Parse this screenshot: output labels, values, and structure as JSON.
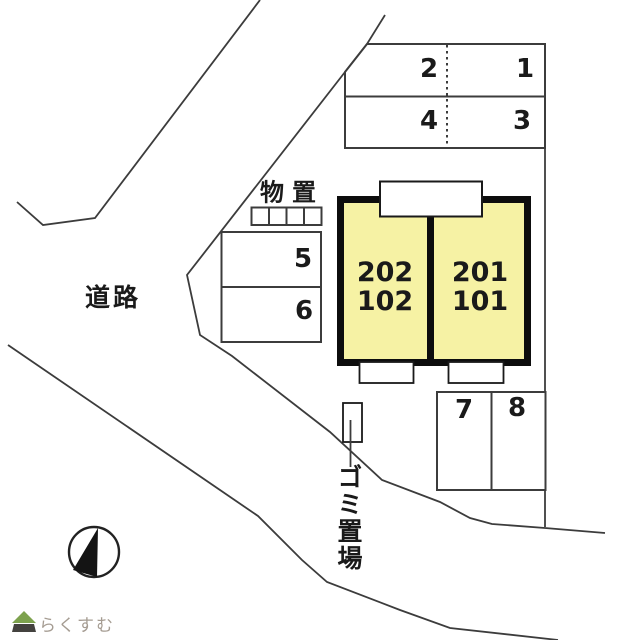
{
  "plan": {
    "road_label": "道路",
    "storage_label": "物置",
    "garbage_label": "ゴミ置場",
    "building": {
      "unit_left_upper": "202",
      "unit_left_lower": "102",
      "unit_right_upper": "201",
      "unit_right_lower": "101"
    },
    "parking": {
      "north_block": [
        "2",
        "1",
        "4",
        "3"
      ],
      "west_block": [
        "5",
        "6"
      ],
      "south_block": [
        "7",
        "8"
      ]
    }
  },
  "icons": {
    "compass": "north-arrow-icon",
    "logo": "house-icon"
  },
  "watermark": {
    "text": "らくすむ"
  },
  "colors": {
    "line": "#3c3c3c",
    "building_border": "#0d0d0d",
    "building_fill": "#f6f2a4",
    "text": "#1a1a1a",
    "watermark_text": "#a59c92",
    "logo_green": "#7da24e",
    "logo_dark": "#44423f"
  }
}
